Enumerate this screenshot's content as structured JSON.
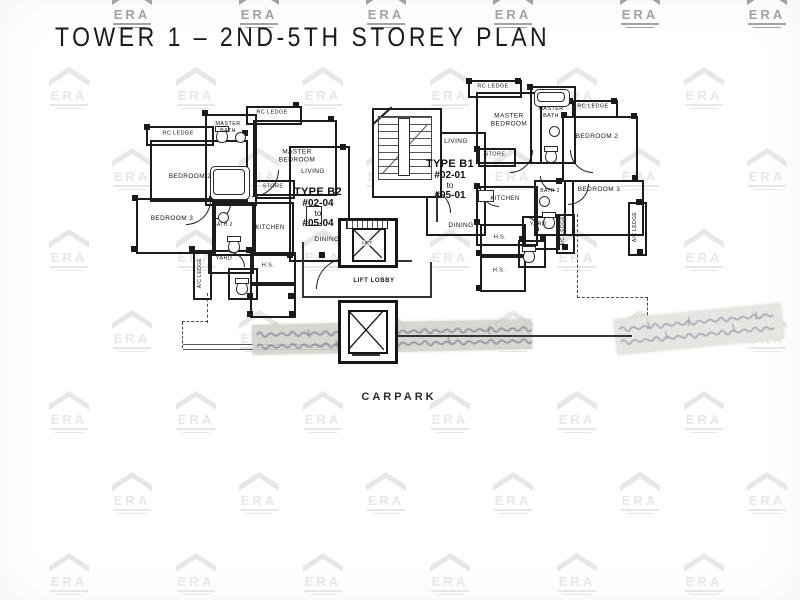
{
  "title": "TOWER 1 – 2ND-5TH STOREY PLAN",
  "watermark": {
    "brand": "ERA",
    "faint_color": "#e7e7e7",
    "dark_color": "#a2a2a2"
  },
  "plan": {
    "carpark_label": "CARPARK",
    "lift_lobby_label": "LIFT LOBBY",
    "lift_label": "LIFT",
    "ink_color": "#1c1c1c",
    "units": [
      {
        "id": "b2",
        "type_name": "TYPE B2",
        "unit_from": "#02-04",
        "to_word": "to",
        "unit_to": "#05-04",
        "rooms": [
          {
            "id": "rc_ledge_a",
            "label": "RC LEDGE"
          },
          {
            "id": "rc_ledge_b",
            "label": "RC LEDGE"
          },
          {
            "id": "bedroom2",
            "label": "BEDROOM 2"
          },
          {
            "id": "master_bath",
            "label": "MASTER BATH"
          },
          {
            "id": "master_bedroom",
            "label": "MASTER BEDROOM"
          },
          {
            "id": "store",
            "label": "STORE"
          },
          {
            "id": "living",
            "label": "LIVING"
          },
          {
            "id": "dining",
            "label": "DINING"
          },
          {
            "id": "bedroom3",
            "label": "BEDROOM 3"
          },
          {
            "id": "bath2",
            "label": "BATH 2"
          },
          {
            "id": "kitchen",
            "label": "KITCHEN"
          },
          {
            "id": "yard",
            "label": "YARD"
          },
          {
            "id": "ac_ledge",
            "label": "A/C LEDGE"
          },
          {
            "id": "hs",
            "label": "H.S."
          }
        ]
      },
      {
        "id": "b1",
        "type_name": "TYPE B1",
        "unit_from": "#02-01",
        "to_word": "to",
        "unit_to": "#05-01",
        "rooms": [
          {
            "id": "rc_ledge_a",
            "label": "RC LEDGE"
          },
          {
            "id": "rc_ledge_b",
            "label": "RC LEDGE"
          },
          {
            "id": "master_bedroom",
            "label": "MASTER BEDROOM"
          },
          {
            "id": "master_bath",
            "label": "MASTER BATH"
          },
          {
            "id": "bedroom2",
            "label": "BEDROOM 2"
          },
          {
            "id": "store",
            "label": "STORE"
          },
          {
            "id": "living",
            "label": "LIVING"
          },
          {
            "id": "dining",
            "label": "DINING"
          },
          {
            "id": "kitchen",
            "label": "KITCHEN"
          },
          {
            "id": "bath2",
            "label": "BATH 2"
          },
          {
            "id": "bedroom3",
            "label": "BEDROOM 3"
          },
          {
            "id": "yard",
            "label": "YARD"
          },
          {
            "id": "ac_ledge",
            "label": "A/C LEDGE"
          },
          {
            "id": "ac_ledge_b",
            "label": "A/C LEDGE"
          },
          {
            "id": "hs_a",
            "label": "H.S."
          },
          {
            "id": "hs_b",
            "label": "H.S."
          }
        ]
      }
    ]
  }
}
